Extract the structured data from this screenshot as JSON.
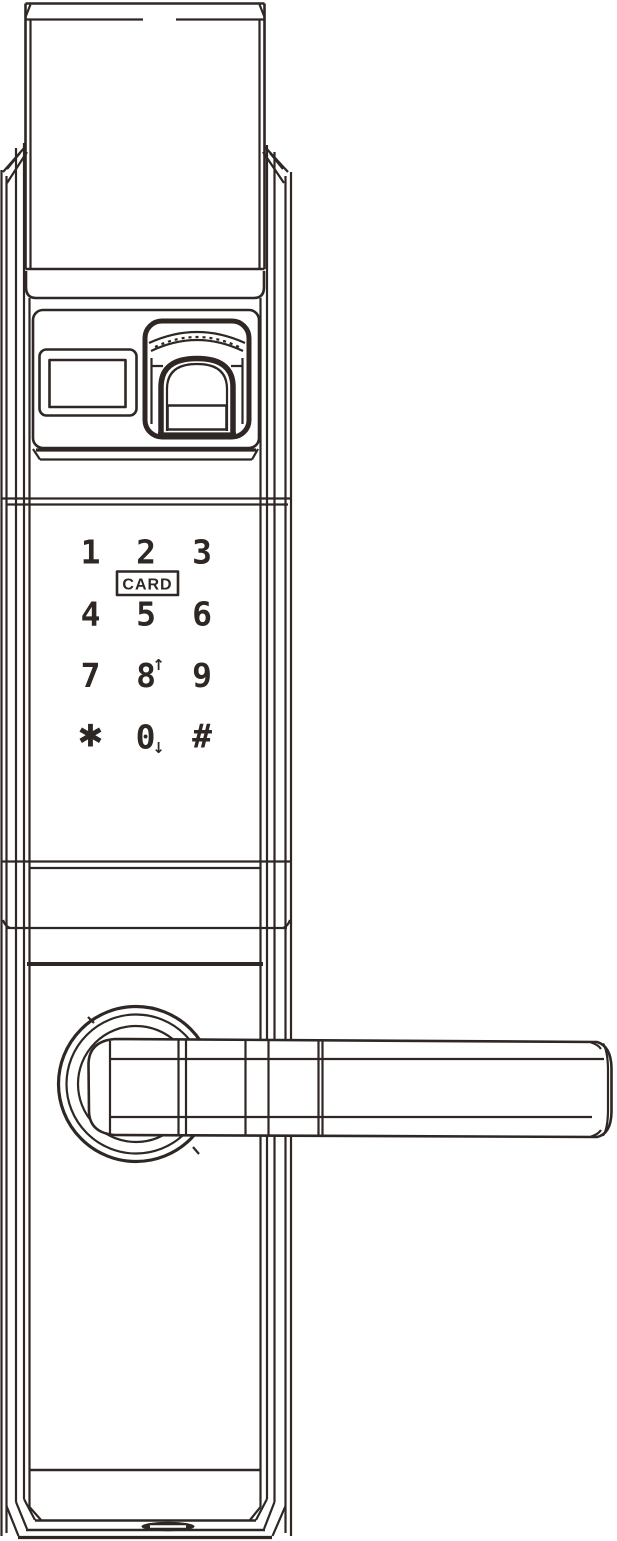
{
  "colors": {
    "line_ink": "#2e2724",
    "background": "#ffffff"
  },
  "keypad": {
    "card_label": "CARD",
    "rows": [
      {
        "keys": [
          {
            "label": "1"
          },
          {
            "label": "2"
          },
          {
            "label": "3"
          }
        ]
      },
      {
        "keys": [
          {
            "label": "4"
          },
          {
            "label": "5"
          },
          {
            "label": "6"
          }
        ]
      },
      {
        "keys": [
          {
            "label": "7"
          },
          {
            "label": "8",
            "suffix": "↑"
          },
          {
            "label": "9"
          }
        ]
      },
      {
        "keys": [
          {
            "label": "*",
            "glyph": "✱"
          },
          {
            "label": "0",
            "suffix": "↓"
          },
          {
            "label": "#"
          }
        ]
      }
    ]
  }
}
